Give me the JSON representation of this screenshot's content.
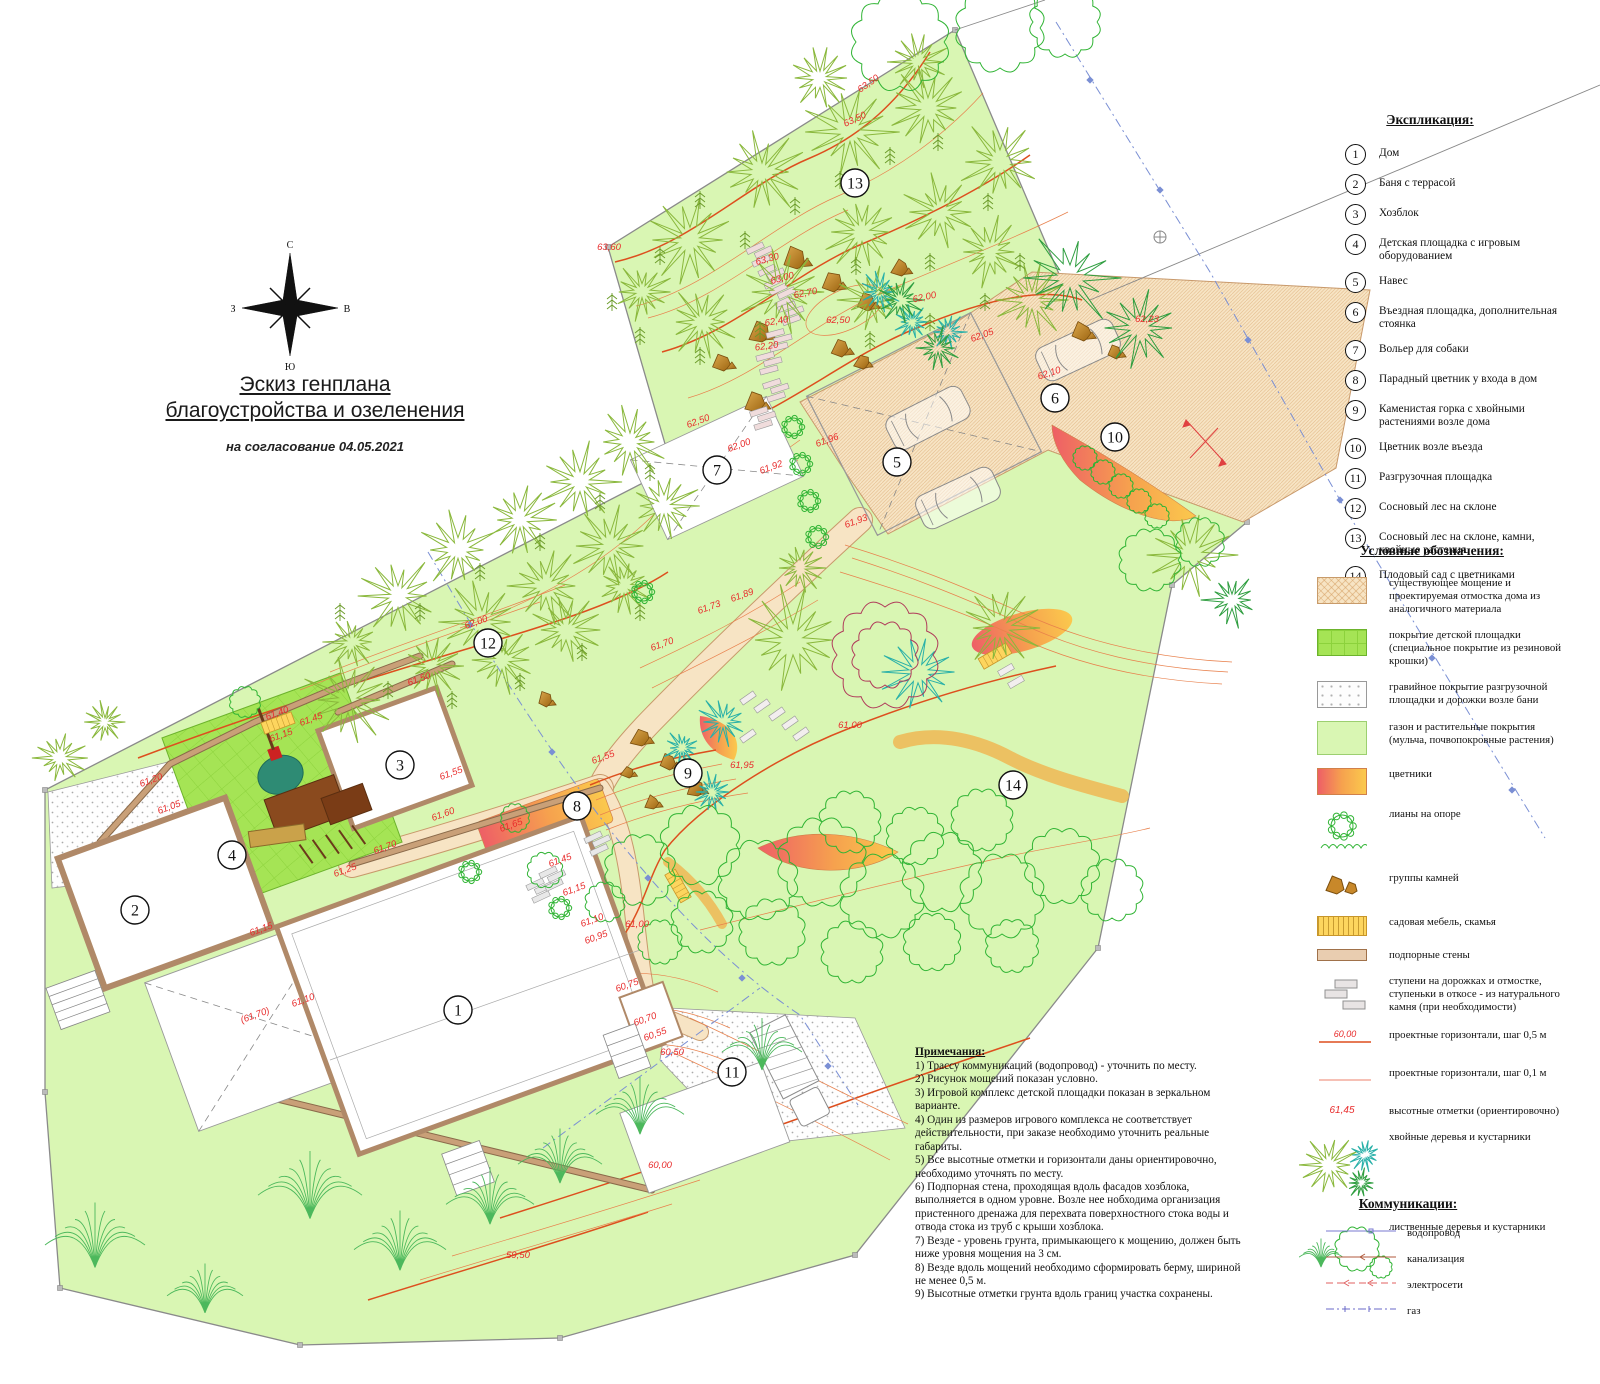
{
  "title_block": {
    "line1": "Эскиз генплана",
    "line2": "благоустройства и озеленения",
    "subtitle": "на согласование 04.05.2021"
  },
  "compass": {
    "n": "С",
    "e": "В",
    "w": "З",
    "s": "Ю"
  },
  "explication": {
    "header": "Экспликация:",
    "items": [
      {
        "num": "1",
        "label": "Дом"
      },
      {
        "num": "2",
        "label": "Баня с террасой"
      },
      {
        "num": "3",
        "label": "Хозблок"
      },
      {
        "num": "4",
        "label": "Детская площадка с игровым оборудованием"
      },
      {
        "num": "5",
        "label": "Навес"
      },
      {
        "num": "6",
        "label": "Въездная площадка, дополнительная стоянка"
      },
      {
        "num": "7",
        "label": "Вольер для собаки"
      },
      {
        "num": "8",
        "label": "Парадный цветник у входа в дом"
      },
      {
        "num": "9",
        "label": "Каменистая горка с хвойными растениями возле дома"
      },
      {
        "num": "10",
        "label": "Цветник возле въезда"
      },
      {
        "num": "11",
        "label": "Разгрузочная площадка"
      },
      {
        "num": "12",
        "label": "Сосновый лес на склоне"
      },
      {
        "num": "13",
        "label": "Сосновый лес на склоне, камни, хвойные растения"
      },
      {
        "num": "14",
        "label": "Плодовый сад с цветниками"
      }
    ]
  },
  "symbols": {
    "header": "Условные обозначения:",
    "items": [
      {
        "type": "paving",
        "label": "существующее мощение и проектируемая отмостка дома из аналогичного материала"
      },
      {
        "type": "playground",
        "label": "покрытие детской площадки (специальное покрытие из резиновой крошки)"
      },
      {
        "type": "gravel",
        "label": "гравийное покрытие разгрузочной площадки и дорожки возле бани"
      },
      {
        "type": "lawn",
        "label": "газон и растительные покрытия (мульча, почвопокровные растения)"
      },
      {
        "type": "flowers",
        "label": "цветники"
      },
      {
        "type": "liana",
        "label": "лианы на опоре"
      },
      {
        "type": "rocks",
        "label": "группы камней"
      },
      {
        "type": "bench",
        "label": "садовая мебель, скамья"
      },
      {
        "type": "wall",
        "label": "подпорные стены"
      },
      {
        "type": "steps",
        "label": "ступени на дорожках и отмостке, ступеньки в откосе - из натурального камня (при необходимости)"
      },
      {
        "type": "contour05",
        "label": "проектные горизонтали, шаг 0,5 м",
        "sample": "60,00"
      },
      {
        "type": "contour01",
        "label": "проектные горизонтали, шаг 0,1 м"
      },
      {
        "type": "spot",
        "label": "высотные отметки  (ориентировочно)",
        "sample": "61,45"
      },
      {
        "type": "conifers",
        "label": "хвойные деревья и кустарники"
      },
      {
        "type": "decid",
        "label": "лиственные деревья и кустарники"
      }
    ]
  },
  "communications": {
    "header": "Коммуникации:",
    "items": [
      {
        "type": "water",
        "label": "водопровод"
      },
      {
        "type": "sewer",
        "label": "канализация"
      },
      {
        "type": "electric",
        "label": "электросети"
      },
      {
        "type": "gas",
        "label": "газ"
      }
    ]
  },
  "notes": {
    "header": "Примечания:",
    "lines": [
      "1) Трассу коммуникаций (водопровод) - уточнить по месту.",
      "2) Рисунок мощений показан условно.",
      "3) Игровой комплекс детской площадки показан в зеркальном варианте.",
      "4) Один из размеров игрового комплекса не соответствует действительности, при заказе необходимо уточнить реальные габариты.",
      "5) Все высотные отметки и горизонтали даны ориентировочно, необходимо уточнять по месту.",
      "6) Подпорная стена, проходящая вдоль фасадов хозблока, выполняется в одном уровне. Возле нее нобходима организация пристенного дренажа для перехвата поверхностного стока воды и отвода стока из труб с крыши хозблока.",
      "7) Везде - уровень грунта, примыкающего к мощению,  должен быть ниже уровня мощения на 3 см.",
      "8) Везде вдоль мощений необходимо сформировать берму, шириной не менее 0,5 м.",
      "9) Высотные отметки грунта вдоль границ участка сохранены."
    ]
  },
  "plan": {
    "colors": {
      "lawn": "#d9f6b3",
      "playground": "#a5e455",
      "paving": "#f7e4c4",
      "contour_thick": "#dd4f1e",
      "contour_thin": "#e8804c",
      "elevation_text": "#e82c2c",
      "water_line": "#7a8fd4",
      "boundary": "#8a8a8a",
      "wall": "#c9a078",
      "pine": "#8ab83c",
      "conifer_dark": "#2f9e40",
      "teal": "#28b0a8",
      "decid": "#30b434",
      "fan": "#4cb85c",
      "red_tree": "#b03a5a",
      "rock": "#c8882a",
      "bench": "#fdd55e",
      "flower1": "#ee5f66",
      "flower2": "#fbc94d"
    },
    "markers": [
      {
        "num": "1",
        "x": 458,
        "y": 1010
      },
      {
        "num": "2",
        "x": 135,
        "y": 910
      },
      {
        "num": "3",
        "x": 400,
        "y": 765
      },
      {
        "num": "4",
        "x": 232,
        "y": 855
      },
      {
        "num": "5",
        "x": 897,
        "y": 462
      },
      {
        "num": "6",
        "x": 1055,
        "y": 398
      },
      {
        "num": "7",
        "x": 717,
        "y": 470
      },
      {
        "num": "8",
        "x": 577,
        "y": 806
      },
      {
        "num": "9",
        "x": 688,
        "y": 773
      },
      {
        "num": "10",
        "x": 1115,
        "y": 437
      },
      {
        "num": "11",
        "x": 732,
        "y": 1072
      },
      {
        "num": "12",
        "x": 488,
        "y": 643
      },
      {
        "num": "13",
        "x": 855,
        "y": 183
      },
      {
        "num": "14",
        "x": 1013,
        "y": 785
      }
    ],
    "elevations": [
      {
        "t": "63,50",
        "x": 870,
        "y": 86,
        "r": -35
      },
      {
        "t": "63,50",
        "x": 856,
        "y": 122,
        "r": -25
      },
      {
        "t": "63,60",
        "x": 609,
        "y": 250,
        "r": 0
      },
      {
        "t": "63,30",
        "x": 768,
        "y": 262,
        "r": -15
      },
      {
        "t": "63,00",
        "x": 783,
        "y": 281,
        "r": -15
      },
      {
        "t": "62,70",
        "x": 806,
        "y": 296,
        "r": -12
      },
      {
        "t": "62,40",
        "x": 777,
        "y": 324,
        "r": -10
      },
      {
        "t": "62,20",
        "x": 767,
        "y": 349,
        "r": -8
      },
      {
        "t": "62,50",
        "x": 838,
        "y": 323,
        "r": 0
      },
      {
        "t": "62,00",
        "x": 925,
        "y": 300,
        "r": -12
      },
      {
        "t": "62,05",
        "x": 983,
        "y": 338,
        "r": -20
      },
      {
        "t": "62,23",
        "x": 1147,
        "y": 322,
        "r": 0
      },
      {
        "t": "62,10",
        "x": 1050,
        "y": 376,
        "r": -18
      },
      {
        "t": "62,50",
        "x": 699,
        "y": 424,
        "r": -20
      },
      {
        "t": "62,00",
        "x": 740,
        "y": 448,
        "r": -20
      },
      {
        "t": "61,92",
        "x": 772,
        "y": 470,
        "r": -20
      },
      {
        "t": "61,96",
        "x": 828,
        "y": 443,
        "r": -20
      },
      {
        "t": "61,93",
        "x": 857,
        "y": 524,
        "r": -20
      },
      {
        "t": "61,89",
        "x": 743,
        "y": 598,
        "r": -20
      },
      {
        "t": "61,73",
        "x": 710,
        "y": 610,
        "r": -20
      },
      {
        "t": "61,70",
        "x": 663,
        "y": 647,
        "r": -20
      },
      {
        "t": "62,00",
        "x": 477,
        "y": 625,
        "r": -20
      },
      {
        "t": "61,50",
        "x": 420,
        "y": 682,
        "r": -20
      },
      {
        "t": "61,55",
        "x": 604,
        "y": 760,
        "r": -20
      },
      {
        "t": "61,95",
        "x": 742,
        "y": 768,
        "r": 0
      },
      {
        "t": "61,00",
        "x": 850,
        "y": 728,
        "r": 0
      },
      {
        "t": "61,40",
        "x": 278,
        "y": 716,
        "r": -20
      },
      {
        "t": "61,45",
        "x": 312,
        "y": 722,
        "r": -20
      },
      {
        "t": "61,15",
        "x": 282,
        "y": 738,
        "r": -20
      },
      {
        "t": "61,20",
        "x": 152,
        "y": 783,
        "r": -20
      },
      {
        "t": "61,05",
        "x": 170,
        "y": 810,
        "r": -20
      },
      {
        "t": "61,55",
        "x": 452,
        "y": 776,
        "r": -20
      },
      {
        "t": "61,60",
        "x": 444,
        "y": 817,
        "r": -20
      },
      {
        "t": "61,65",
        "x": 512,
        "y": 828,
        "r": -20
      },
      {
        "t": "61,70",
        "x": 386,
        "y": 850,
        "r": -20
      },
      {
        "t": "61,25",
        "x": 346,
        "y": 873,
        "r": -20
      },
      {
        "t": "61,15",
        "x": 262,
        "y": 932,
        "r": -20
      },
      {
        "t": "61,10",
        "x": 304,
        "y": 1003,
        "r": -20
      },
      {
        "t": "(61,70)",
        "x": 256,
        "y": 1018,
        "r": -20
      },
      {
        "t": "61,45",
        "x": 561,
        "y": 863,
        "r": -20
      },
      {
        "t": "61,15",
        "x": 575,
        "y": 892,
        "r": -20
      },
      {
        "t": "61,10",
        "x": 593,
        "y": 923,
        "r": -20
      },
      {
        "t": "60,95",
        "x": 597,
        "y": 940,
        "r": -20
      },
      {
        "t": "61,00",
        "x": 637,
        "y": 927,
        "r": 0
      },
      {
        "t": "60,75",
        "x": 628,
        "y": 988,
        "r": -20
      },
      {
        "t": "60,70",
        "x": 646,
        "y": 1022,
        "r": -20
      },
      {
        "t": "60,55",
        "x": 656,
        "y": 1037,
        "r": -20
      },
      {
        "t": "60,50",
        "x": 672,
        "y": 1055,
        "r": 0
      },
      {
        "t": "60,00",
        "x": 660,
        "y": 1168,
        "r": 0
      },
      {
        "t": "59,50",
        "x": 518,
        "y": 1258,
        "r": 0
      }
    ]
  }
}
